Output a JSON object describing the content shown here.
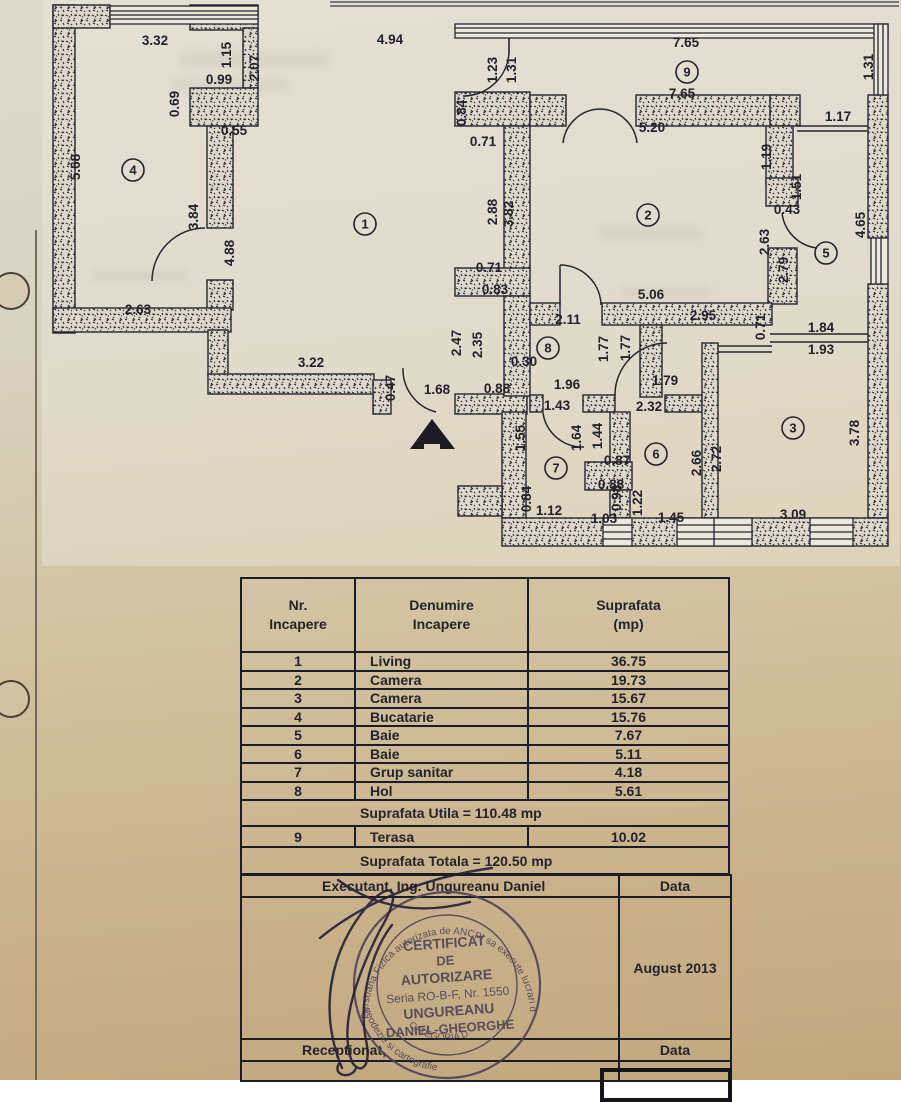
{
  "plan": {
    "entrance_arrow": "entrance-arrow",
    "room_circles": [
      {
        "n": "1",
        "x": 365,
        "y": 224
      },
      {
        "n": "2",
        "x": 648,
        "y": 215
      },
      {
        "n": "3",
        "x": 793,
        "y": 428
      },
      {
        "n": "4",
        "x": 133,
        "y": 170
      },
      {
        "n": "5",
        "x": 826,
        "y": 253
      },
      {
        "n": "6",
        "x": 656,
        "y": 454
      },
      {
        "n": "7",
        "x": 556,
        "y": 468
      },
      {
        "n": "8",
        "x": 548,
        "y": 348
      },
      {
        "n": "9",
        "x": 687,
        "y": 72
      }
    ],
    "dims": [
      {
        "t": "3.32",
        "x": 155,
        "y": 45
      },
      {
        "t": "4.94",
        "x": 390,
        "y": 44
      },
      {
        "t": "1.23",
        "x": 497,
        "y": 70,
        "v": 1
      },
      {
        "t": "1.31",
        "x": 516,
        "y": 70,
        "v": 1
      },
      {
        "t": "7.65",
        "x": 686,
        "y": 47
      },
      {
        "t": "1.31",
        "x": 873,
        "y": 67,
        "v": 1
      },
      {
        "t": "7.65",
        "x": 682,
        "y": 98
      },
      {
        "t": "1.15",
        "x": 231,
        "y": 55,
        "v": 1
      },
      {
        "t": "2.07",
        "x": 259,
        "y": 68,
        "v": 1
      },
      {
        "t": "0.99",
        "x": 219,
        "y": 84
      },
      {
        "t": "0.69",
        "x": 179,
        "y": 104,
        "v": 1
      },
      {
        "t": "0.55",
        "x": 234,
        "y": 135
      },
      {
        "t": "0.84",
        "x": 466,
        "y": 113,
        "v": 1
      },
      {
        "t": "0.71",
        "x": 483,
        "y": 146
      },
      {
        "t": "5.20",
        "x": 652,
        "y": 132
      },
      {
        "t": "1.17",
        "x": 838,
        "y": 121
      },
      {
        "t": "1.19",
        "x": 771,
        "y": 157,
        "v": 1
      },
      {
        "t": "1.51",
        "x": 801,
        "y": 187,
        "v": 1
      },
      {
        "t": "0.43",
        "x": 787,
        "y": 214
      },
      {
        "t": "5.68",
        "x": 80,
        "y": 167,
        "v": 1
      },
      {
        "t": "3.84",
        "x": 198,
        "y": 217,
        "v": 1
      },
      {
        "t": "4.88",
        "x": 234,
        "y": 253,
        "v": 1
      },
      {
        "t": "2.88",
        "x": 497,
        "y": 212,
        "v": 1
      },
      {
        "t": "3.82",
        "x": 513,
        "y": 214,
        "v": 1
      },
      {
        "t": "2.63",
        "x": 769,
        "y": 242,
        "v": 1
      },
      {
        "t": "2.79",
        "x": 788,
        "y": 270,
        "v": 1
      },
      {
        "t": "4.65",
        "x": 865,
        "y": 225,
        "v": 1
      },
      {
        "t": "2.63",
        "x": 138,
        "y": 314
      },
      {
        "t": "3.22",
        "x": 311,
        "y": 367
      },
      {
        "t": "0.71",
        "x": 489,
        "y": 272
      },
      {
        "t": "0.83",
        "x": 495,
        "y": 294
      },
      {
        "t": "5.06",
        "x": 651,
        "y": 299
      },
      {
        "t": "2.95",
        "x": 703,
        "y": 320
      },
      {
        "t": "0.71",
        "x": 765,
        "y": 327,
        "v": 1
      },
      {
        "t": "1.84",
        "x": 821,
        "y": 332
      },
      {
        "t": "1.93",
        "x": 821,
        "y": 354
      },
      {
        "t": "2.11",
        "x": 568,
        "y": 324
      },
      {
        "t": "2.47",
        "x": 461,
        "y": 343,
        "v": 1
      },
      {
        "t": "2.35",
        "x": 482,
        "y": 345,
        "v": 1
      },
      {
        "t": "1.77",
        "x": 608,
        "y": 349,
        "v": 1
      },
      {
        "t": "1.77",
        "x": 630,
        "y": 348,
        "v": 1
      },
      {
        "t": "0.30",
        "x": 524,
        "y": 366
      },
      {
        "t": "0.47",
        "x": 395,
        "y": 388,
        "v": 1
      },
      {
        "t": "1.68",
        "x": 437,
        "y": 394
      },
      {
        "t": "0.88",
        "x": 497,
        "y": 393
      },
      {
        "t": "1.96",
        "x": 567,
        "y": 389
      },
      {
        "t": "1.43",
        "x": 557,
        "y": 410
      },
      {
        "t": "1.79",
        "x": 665,
        "y": 385
      },
      {
        "t": "2.32",
        "x": 649,
        "y": 411
      },
      {
        "t": "1.55",
        "x": 525,
        "y": 438,
        "v": 1
      },
      {
        "t": "1.64",
        "x": 581,
        "y": 438,
        "v": 1
      },
      {
        "t": "1.44",
        "x": 602,
        "y": 436,
        "v": 1
      },
      {
        "t": "0.87",
        "x": 617,
        "y": 465
      },
      {
        "t": "0.84",
        "x": 531,
        "y": 499,
        "v": 1
      },
      {
        "t": "0.88",
        "x": 611,
        "y": 489
      },
      {
        "t": "0.98",
        "x": 621,
        "y": 498,
        "v": 1
      },
      {
        "t": "1.22",
        "x": 642,
        "y": 503,
        "v": 1
      },
      {
        "t": "1.12",
        "x": 549,
        "y": 515
      },
      {
        "t": "1.03",
        "x": 604,
        "y": 523
      },
      {
        "t": "1.45",
        "x": 671,
        "y": 522
      },
      {
        "t": "3.09",
        "x": 793,
        "y": 519
      },
      {
        "t": "3.78",
        "x": 859,
        "y": 433,
        "v": 1
      },
      {
        "t": "2.66",
        "x": 701,
        "y": 463,
        "v": 1
      },
      {
        "t": "2.72",
        "x": 721,
        "y": 459,
        "v": 1
      }
    ]
  },
  "table": {
    "headers": [
      [
        "Nr.",
        "Incapere"
      ],
      [
        "Denumire",
        "Incapere"
      ],
      [
        "Suprafata",
        "(mp)"
      ]
    ],
    "rows": [
      {
        "nr": "1",
        "name": "Living",
        "area": "36.75"
      },
      {
        "nr": "2",
        "name": "Camera",
        "area": "19.73"
      },
      {
        "nr": "3",
        "name": "Camera",
        "area": "15.67"
      },
      {
        "nr": "4",
        "name": "Bucatarie",
        "area": "15.76"
      },
      {
        "nr": "5",
        "name": "Baie",
        "area": "7.67"
      },
      {
        "nr": "6",
        "name": "Baie",
        "area": "5.11"
      },
      {
        "nr": "7",
        "name": "Grup sanitar",
        "area": "4.18"
      },
      {
        "nr": "8",
        "name": "Hol",
        "area": "5.61"
      }
    ],
    "utila": "Suprafata Utila = 110.48 mp",
    "terasa": {
      "nr": "9",
      "name": "Terasa",
      "area": "10.02"
    },
    "totala": "Suprafata Totala = 120.50 mp",
    "executant": "Executant, Ing. Ungureanu Daniel",
    "data_label_1": "Data",
    "date_value": "August 2013",
    "receptionat": "Receptionat,",
    "data_label_2": "Data"
  },
  "stamp": {
    "arc_top": "Persoana Fizica autorizata de ANCPI sa execute lucrari de cadastru,",
    "arc_bottom": "geodezie si cartografie",
    "line1": "CERTIFICAT",
    "line2": "DE",
    "line3": "AUTORIZARE",
    "line4": "Seria RO-B-F, Nr. 1550",
    "line5": "UNGUREANU",
    "line6": "DANIEL-GHEORGHE",
    "category": "CATEGORIA D"
  }
}
